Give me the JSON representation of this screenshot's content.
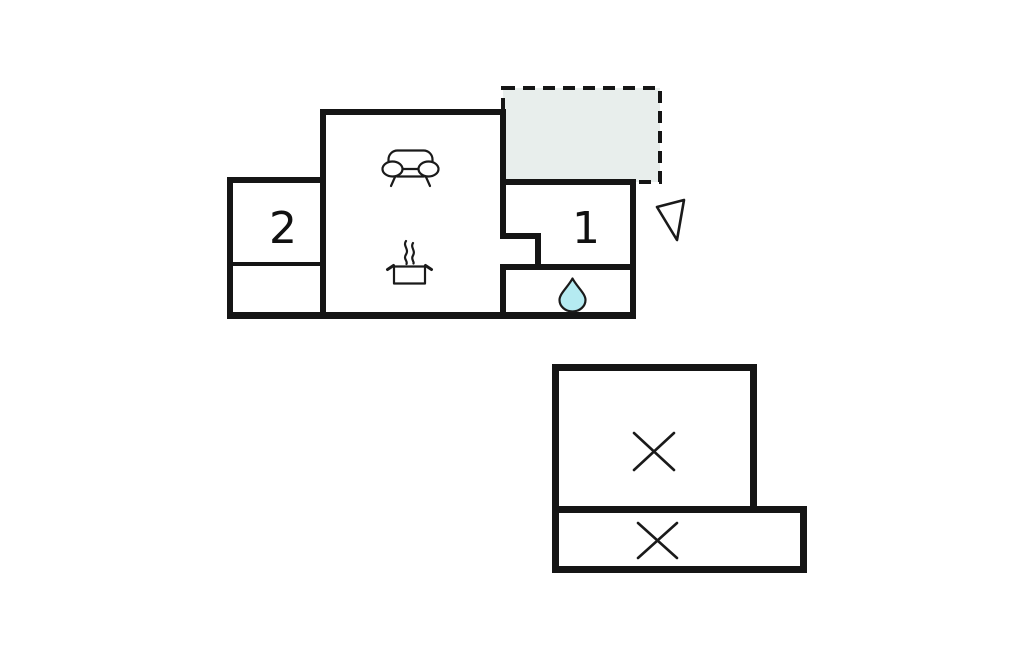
{
  "canvas": {
    "width": 1024,
    "height": 652,
    "background": "#ffffff"
  },
  "floorplan": {
    "main_building": {
      "rooms": [
        {
          "label": "2"
        },
        {
          "label": "1"
        }
      ],
      "icons": [
        "sofa-icon",
        "stove-icon",
        "water-drop-icon",
        "north-arrow-icon"
      ],
      "terrace": {
        "fill": "#e8eeec",
        "border_style": "dashed"
      }
    },
    "annex_building": {
      "markers": [
        "cross-icon",
        "cross-icon"
      ]
    },
    "colors": {
      "wall": "#151515",
      "line": "#1a1a1a",
      "terrace_fill": "#e8eeec",
      "water_drop_fill": "#b5ebf1",
      "background": "#ffffff"
    }
  }
}
